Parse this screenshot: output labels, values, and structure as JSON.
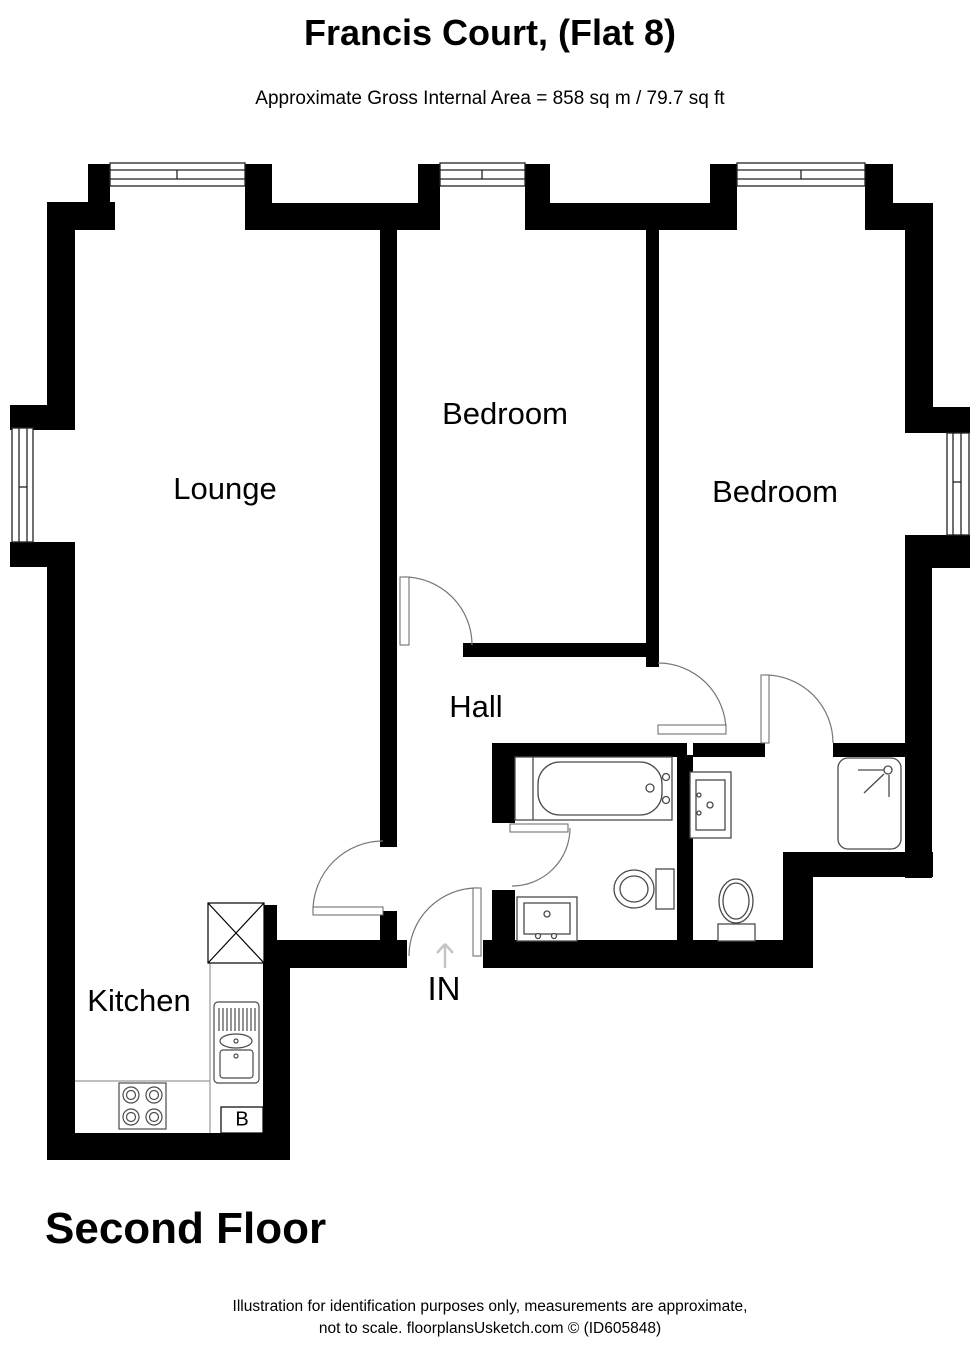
{
  "header": {
    "title": "Francis Court, (Flat 8)",
    "subtitle": "Approximate Gross Internal Area = 858 sq m / 79.7 sq ft"
  },
  "rooms": {
    "lounge": "Lounge",
    "bedroom_middle": "Bedroom",
    "bedroom_right": "Bedroom",
    "hall": "Hall",
    "kitchen": "Kitchen"
  },
  "annotations": {
    "entrance": "IN",
    "boiler": "B"
  },
  "floor_label": "Second Floor",
  "footer": {
    "line1": "Illustration for identification purposes only, measurements are approximate,",
    "line2": "not to scale. floorplansUsketch.com © (ID605848)"
  },
  "colors": {
    "wall": "#000000",
    "background": "#ffffff",
    "fixture_stroke": "#4a4a4a",
    "door_stroke": "#777777"
  }
}
